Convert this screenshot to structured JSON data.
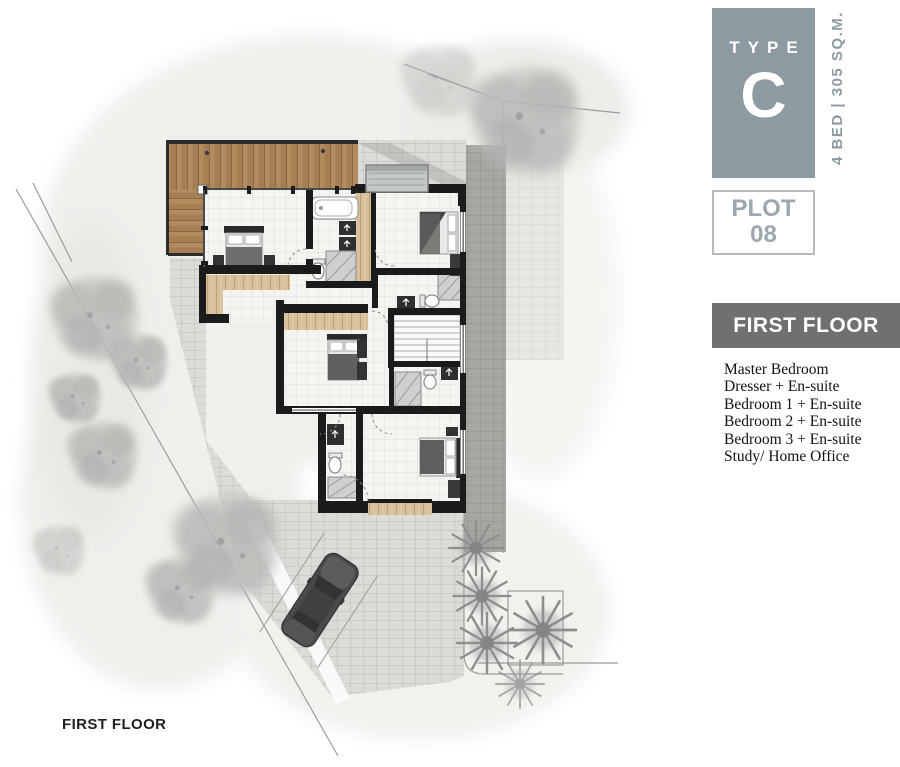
{
  "panel": {
    "type_label": "TYPE",
    "type_value": "C",
    "spec_label": "4 BED | 305 SQ.M.",
    "plot_label": "PLOT",
    "plot_number": "08",
    "floor_header": "FIRST FLOOR",
    "rooms": [
      "Master Bedroom",
      "Dresser + En-suite",
      "Bedroom 1 + En-suite",
      "Bedroom 2 + En-suite",
      "Bedroom 3 + En-suite",
      "Study/ Home Office"
    ]
  },
  "plan": {
    "caption": "FIRST FLOOR"
  },
  "colors": {
    "slate": "#8C9BA1",
    "slate-light": "#9CA8AD",
    "bar": "#6F7071",
    "ink": "#231F20",
    "wall": "#1B1B1B",
    "deck-a": "#B28C5E",
    "deck-b": "#A57F53",
    "wood-furn": "#D8C19A",
    "floor": "#F4F4F1",
    "paver-light": "#DCDBD8",
    "paver-dark": "#A8A6A3",
    "boundary": "#9B9B9B",
    "car-body": "#4A4A4A"
  }
}
